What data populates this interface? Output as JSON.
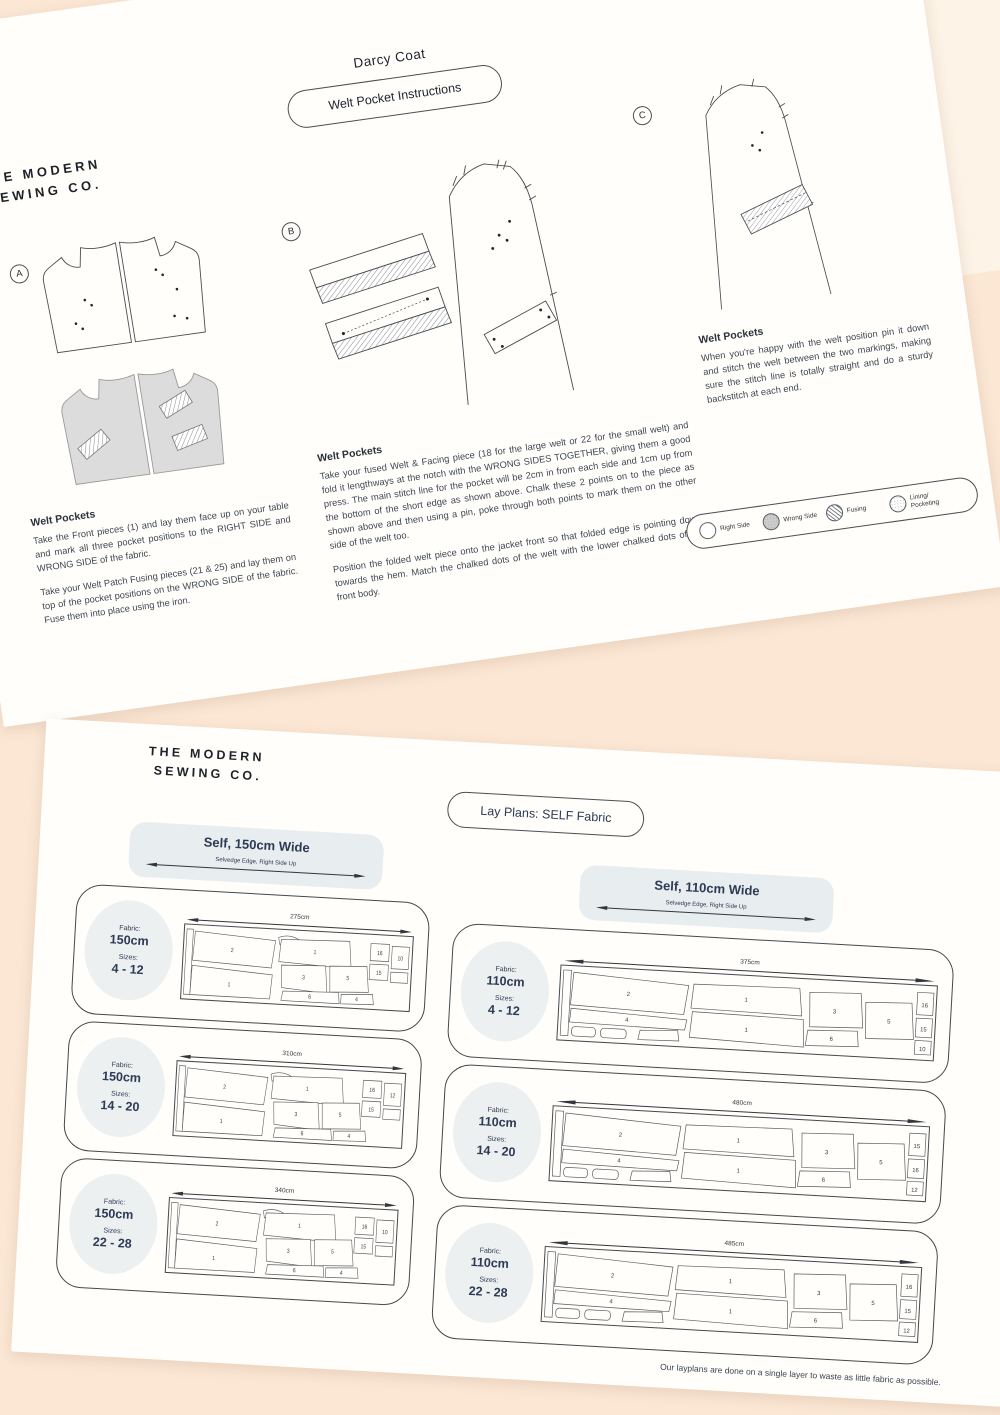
{
  "colors": {
    "background": "#fbe7d4",
    "paper": "#fffefb",
    "navy_accent": "#2d3a55",
    "ink": "#3f4652",
    "label_oval": "#edf0f1"
  },
  "page1": {
    "hashtags": [
      "#MSCdarcycoat",
      "#modernsewingco",
      "@modern_sewing_co"
    ],
    "logo": {
      "line1": "THE MODERN",
      "line2": "SEWING CO."
    },
    "title": "Darcy Coat",
    "subtitle": "Welt Pocket Instructions",
    "sections": [
      {
        "letter": "A",
        "heading": "Welt Pockets",
        "para1": "Take the Front pieces (1) and lay them face up on your table and mark all three pocket positions to the RIGHT SIDE and WRONG SIDE of the fabric.",
        "para2": "Take your Welt Patch Fusing pieces (21 & 25) and lay them on top of the pocket positions on the WRONG SIDE of the fabric. Fuse them into place using the iron."
      },
      {
        "letter": "B",
        "heading": "Welt Pockets",
        "para1": "Take your fused Welt & Facing piece (18 for the large welt or 22 for the small welt) and fold it lengthways at the notch with the WRONG SIDES TOGETHER, giving them a good press. The main stitch line for the pocket will be 2cm in from each side and 1cm up from the bottom of the short edge as shown above. Chalk these 2 points on to the piece as shown above and then using a pin, poke through both points to mark them on the other side of the welt too.",
        "para2": "Position the folded welt piece onto the jacket front so that folded edge is pointing down towards the hem. Match the chalked dots of the welt with the lower chalked dots of the front body."
      },
      {
        "letter": "C",
        "heading": "Welt Pockets",
        "para1": "When you're happy with the welt position pin it down and stitch the welt between the two markings, making sure the stitch line is totally straight and do a sturdy backstitch at each end.",
        "para2": ""
      }
    ],
    "legend": {
      "right_side": "Right Side",
      "wrong_side": "Wrong Side",
      "fusing": "Fusing",
      "lining": "Lining/ Pocketing"
    }
  },
  "page2": {
    "logo": {
      "line1": "THE MODERN",
      "line2": "SEWING CO."
    },
    "title": "Lay Plans: SELF Fabric",
    "selvedge_note": "Selvedge Edge, Right Side Up",
    "columns": [
      {
        "header": "Self, 150cm Wide",
        "plans": [
          {
            "fabric_label": "Fabric:",
            "fabric": "150cm",
            "sizes_label": "Sizes:",
            "sizes": "4 - 12",
            "length": "275cm",
            "pieces": [
              "2",
              "1",
              "1",
              "3",
              "5",
              "6",
              "4",
              "16",
              "15",
              "10"
            ]
          },
          {
            "fabric_label": "Fabric:",
            "fabric": "150cm",
            "sizes_label": "Sizes:",
            "sizes": "14 - 20",
            "length": "310cm",
            "pieces": [
              "2",
              "1",
              "1",
              "3",
              "5",
              "6",
              "4",
              "16",
              "15",
              "12"
            ]
          },
          {
            "fabric_label": "Fabric:",
            "fabric": "150cm",
            "sizes_label": "Sizes:",
            "sizes": "22 - 28",
            "length": "340cm",
            "pieces": [
              "2",
              "1",
              "1",
              "3",
              "5",
              "6",
              "4",
              "16",
              "15",
              "10"
            ]
          }
        ]
      },
      {
        "header": "Self, 110cm Wide",
        "plans": [
          {
            "fabric_label": "Fabric:",
            "fabric": "110cm",
            "sizes_label": "Sizes:",
            "sizes": "4 - 12",
            "length": "375cm",
            "pieces": [
              "2",
              "1",
              "1",
              "3",
              "5",
              "6",
              "4",
              "16",
              "15",
              "10"
            ]
          },
          {
            "fabric_label": "Fabric:",
            "fabric": "110cm",
            "sizes_label": "Sizes:",
            "sizes": "14 - 20",
            "length": "480cm",
            "pieces": [
              "2",
              "1",
              "1",
              "3",
              "5",
              "6",
              "4",
              "15",
              "16",
              "12"
            ]
          },
          {
            "fabric_label": "Fabric:",
            "fabric": "110cm",
            "sizes_label": "Sizes:",
            "sizes": "22 - 28",
            "length": "485cm",
            "pieces": [
              "2",
              "1",
              "1",
              "3",
              "5",
              "6",
              "4",
              "16",
              "15",
              "12"
            ]
          }
        ]
      }
    ],
    "footnote": "Our layplans are done on a single layer to waste as little fabric as possible."
  }
}
